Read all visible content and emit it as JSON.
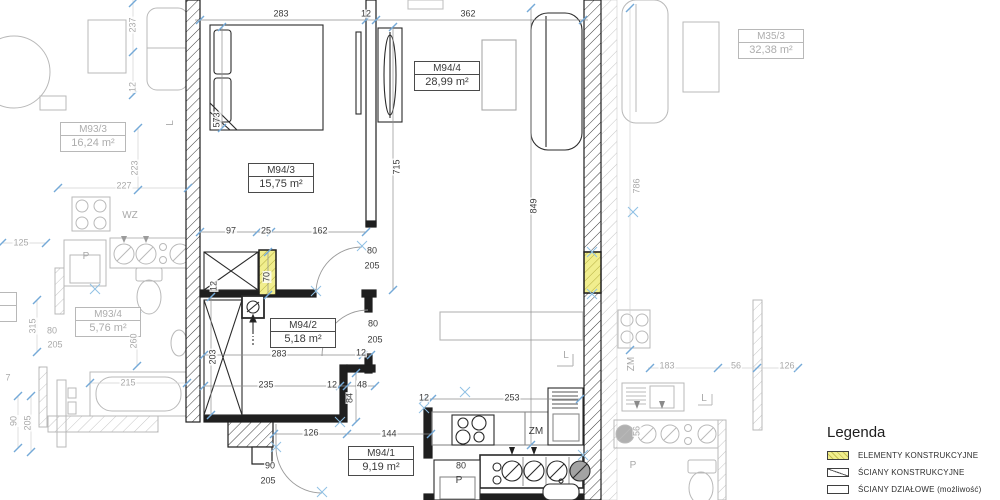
{
  "legend": {
    "title": "Legenda",
    "items": [
      {
        "label": "ELEMENTY KONSTRUKCYJNE",
        "swatch": "yellow-hatch"
      },
      {
        "label": "ŚCIANY KONSTRUKCYJNE",
        "swatch": "diagonal-line"
      },
      {
        "label": "ŚCIANY DZIAŁOWE (możliwość)",
        "swatch": "outline"
      }
    ]
  },
  "colors": {
    "structural_yellow": "#f1ee8e",
    "tick_blue": "#74a9d8",
    "wall_dark": "#1f1f1f",
    "neighbor_gray": "#b5b5b5"
  },
  "plan": {
    "rooms": [
      {
        "id": "M94/3",
        "area": "15,75 m²",
        "x": 281,
        "y": 178
      },
      {
        "id": "M94/4",
        "area": "28,99 m²",
        "x": 447,
        "y": 76
      },
      {
        "id": "M94/2",
        "area": "5,18 m²",
        "x": 303,
        "y": 333
      },
      {
        "id": "M94/1",
        "area": "9,19 m²",
        "x": 381,
        "y": 461
      },
      {
        "id": "M93/3",
        "area": "16,24 m²",
        "x": 93,
        "y": 137,
        "g": 1
      },
      {
        "id": "M93/4",
        "area": "5,76 m²",
        "x": 108,
        "y": 322,
        "g": 1
      },
      {
        "id": "M35/3",
        "area": "32,38 m²",
        "x": 771,
        "y": 44,
        "g": 1
      },
      {
        "id": "3/1",
        "area": "5 m²",
        "x": -16,
        "y": 307,
        "g": 1
      }
    ],
    "dimensions": [
      {
        "t": "283",
        "x": 281,
        "y": 14
      },
      {
        "t": "12",
        "x": 366,
        "y": 14
      },
      {
        "t": "362",
        "x": 468,
        "y": 14
      },
      {
        "t": "573",
        "x": 217,
        "y": 120,
        "v": 1
      },
      {
        "t": "715",
        "x": 397,
        "y": 167,
        "v": 1
      },
      {
        "t": "849",
        "x": 534,
        "y": 206,
        "v": 1
      },
      {
        "t": "97",
        "x": 231,
        "y": 231
      },
      {
        "t": "25",
        "x": 266,
        "y": 231
      },
      {
        "t": "162",
        "x": 320,
        "y": 231
      },
      {
        "t": "80",
        "x": 372,
        "y": 251
      },
      {
        "t": "205",
        "x": 372,
        "y": 266
      },
      {
        "t": "70",
        "x": 267,
        "y": 277,
        "v": 1
      },
      {
        "t": "12",
        "x": 214,
        "y": 286,
        "v": 1
      },
      {
        "t": "80",
        "x": 373,
        "y": 324
      },
      {
        "t": "205",
        "x": 375,
        "y": 340
      },
      {
        "t": "283",
        "x": 279,
        "y": 354
      },
      {
        "t": "12",
        "x": 361,
        "y": 353
      },
      {
        "t": "203",
        "x": 213,
        "y": 357,
        "v": 1
      },
      {
        "t": "235",
        "x": 266,
        "y": 385
      },
      {
        "t": "12",
        "x": 332,
        "y": 385
      },
      {
        "t": "48",
        "x": 362,
        "y": 385
      },
      {
        "t": "84",
        "x": 350,
        "y": 398,
        "v": 1
      },
      {
        "t": "126",
        "x": 311,
        "y": 433
      },
      {
        "t": "144",
        "x": 389,
        "y": 434
      },
      {
        "t": "90",
        "x": 270,
        "y": 466
      },
      {
        "t": "205",
        "x": 268,
        "y": 481
      },
      {
        "t": "12",
        "x": 424,
        "y": 398
      },
      {
        "t": "253",
        "x": 512,
        "y": 398
      },
      {
        "t": "80",
        "x": 461,
        "y": 466
      },
      {
        "t": "P",
        "x": 459,
        "y": 481,
        "fx": 1
      },
      {
        "t": "ZM",
        "x": 536,
        "y": 432,
        "fx": 1
      },
      {
        "t": "L",
        "x": 566,
        "y": 356,
        "g": 1,
        "fx": 1
      },
      {
        "t": "237",
        "x": 133,
        "y": 25,
        "v": 1,
        "g": 1
      },
      {
        "t": "12",
        "x": 133,
        "y": 87,
        "v": 1,
        "g": 1
      },
      {
        "t": "223",
        "x": 135,
        "y": 168,
        "v": 1,
        "g": 1
      },
      {
        "t": "227",
        "x": 124,
        "y": 186,
        "g": 1
      },
      {
        "t": "WZ",
        "x": 130,
        "y": 216,
        "g": 1,
        "fx": 1
      },
      {
        "t": "125",
        "x": 21,
        "y": 243,
        "g": 1
      },
      {
        "t": "P",
        "x": 86,
        "y": 257,
        "g": 1,
        "fx": 1
      },
      {
        "t": "L",
        "x": 171,
        "y": 123,
        "v": 1,
        "g": 1,
        "fx": 1
      },
      {
        "t": "315",
        "x": 33,
        "y": 326,
        "v": 1,
        "g": 1
      },
      {
        "t": "80",
        "x": 52,
        "y": 331,
        "g": 1
      },
      {
        "t": "205",
        "x": 55,
        "y": 345,
        "g": 1
      },
      {
        "t": "260",
        "x": 134,
        "y": 341,
        "v": 1,
        "g": 1
      },
      {
        "t": "215",
        "x": 128,
        "y": 383,
        "g": 1
      },
      {
        "t": "7",
        "x": 8,
        "y": 378,
        "g": 1
      },
      {
        "t": "90",
        "x": 14,
        "y": 421,
        "v": 1,
        "g": 1
      },
      {
        "t": "205",
        "x": 28,
        "y": 423,
        "v": 1,
        "g": 1
      },
      {
        "t": "786",
        "x": 637,
        "y": 186,
        "v": 1,
        "g": 1
      },
      {
        "t": "ZM",
        "x": 632,
        "y": 364,
        "v": 1,
        "g": 1,
        "fx": 1
      },
      {
        "t": "183",
        "x": 667,
        "y": 366,
        "g": 1
      },
      {
        "t": "56",
        "x": 736,
        "y": 366,
        "g": 1
      },
      {
        "t": "126",
        "x": 787,
        "y": 366,
        "g": 1
      },
      {
        "t": "L",
        "x": 704,
        "y": 399,
        "g": 1,
        "fx": 1
      },
      {
        "t": "56",
        "x": 637,
        "y": 431,
        "v": 1,
        "g": 1
      },
      {
        "t": "P",
        "x": 633,
        "y": 466,
        "g": 1,
        "fx": 1
      }
    ]
  }
}
